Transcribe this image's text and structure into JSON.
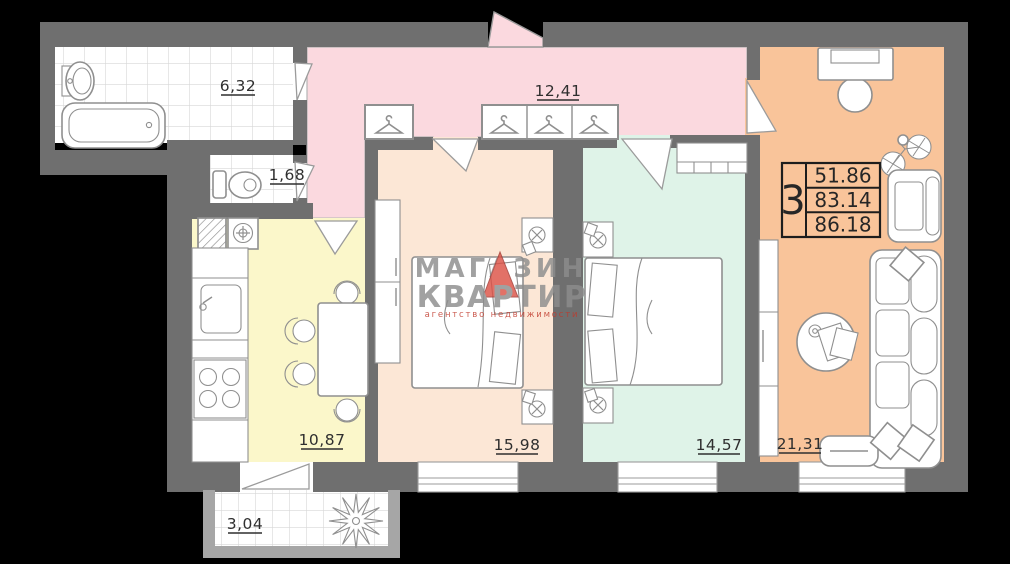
{
  "summary_box": {
    "rooms_count": "3",
    "row1": "51.86",
    "row2": "83.14",
    "row3": "86.18"
  },
  "watermark": {
    "brand_line1": "МАГАЗИН",
    "brand_line2": "КВАРТИР",
    "tagline": "агентство недвижимости"
  },
  "rooms": {
    "bathroom": {
      "area_label": "6,32"
    },
    "wc": {
      "area_label": "1,68"
    },
    "hallway": {
      "area_label": "12,41"
    },
    "kitchen": {
      "area_label": "10,87"
    },
    "bedroom_1": {
      "area_label": "15,98"
    },
    "bedroom_2": {
      "area_label": "14,57"
    },
    "living_room": {
      "area_label": "21,31"
    },
    "balcony": {
      "area_label": "3,04"
    }
  },
  "colors": {
    "background": "#000000",
    "wall": "#6f6f6f",
    "balcony_wall": "#a6a6a6",
    "hallway_fill": "#fbd9df",
    "bedroom_1_fill": "#fce7d6",
    "bedroom_2_fill": "#dff3e8",
    "living_room_fill": "#f9c49a",
    "kitchen_fill": "#fbf7ca",
    "wet_room_fill": "#ffffff",
    "label_color": "#2f2f2f",
    "brand_red": "#dc5246",
    "watermark_gray": "#8d8d8d"
  }
}
